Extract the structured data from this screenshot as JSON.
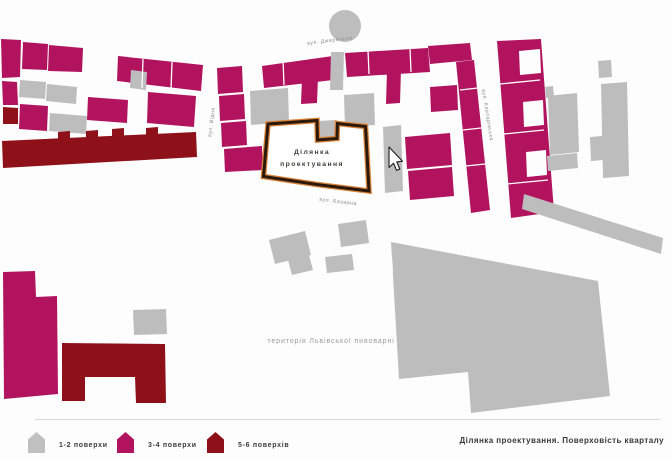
{
  "figure": {
    "site_label": {
      "line1": "Ділянка",
      "line2": "проектування"
    },
    "area_label": "територія Львівської пивоварні",
    "streets": {
      "north": "вул. Джерельна",
      "west": "вул. Відня",
      "south": "вул. Базарна",
      "east": "вул. Клепарівська"
    }
  },
  "legend": {
    "items": [
      {
        "label": "1-2 поверхи",
        "color": "#c0c0c0"
      },
      {
        "label": "3-4 поверхи",
        "color": "#b1135e"
      },
      {
        "label": "5-6 поверхів",
        "color": "#8e1119"
      }
    ],
    "caption": "Ділянка проектування. Поверховість кварталу"
  },
  "colors": {
    "floors_1_2": "#bdbdbd",
    "floors_3_4": "#b1135e",
    "floors_5_6": "#8e1119",
    "site_outline_dark": "#2a190b",
    "site_outline_accent": "#d9833a"
  }
}
